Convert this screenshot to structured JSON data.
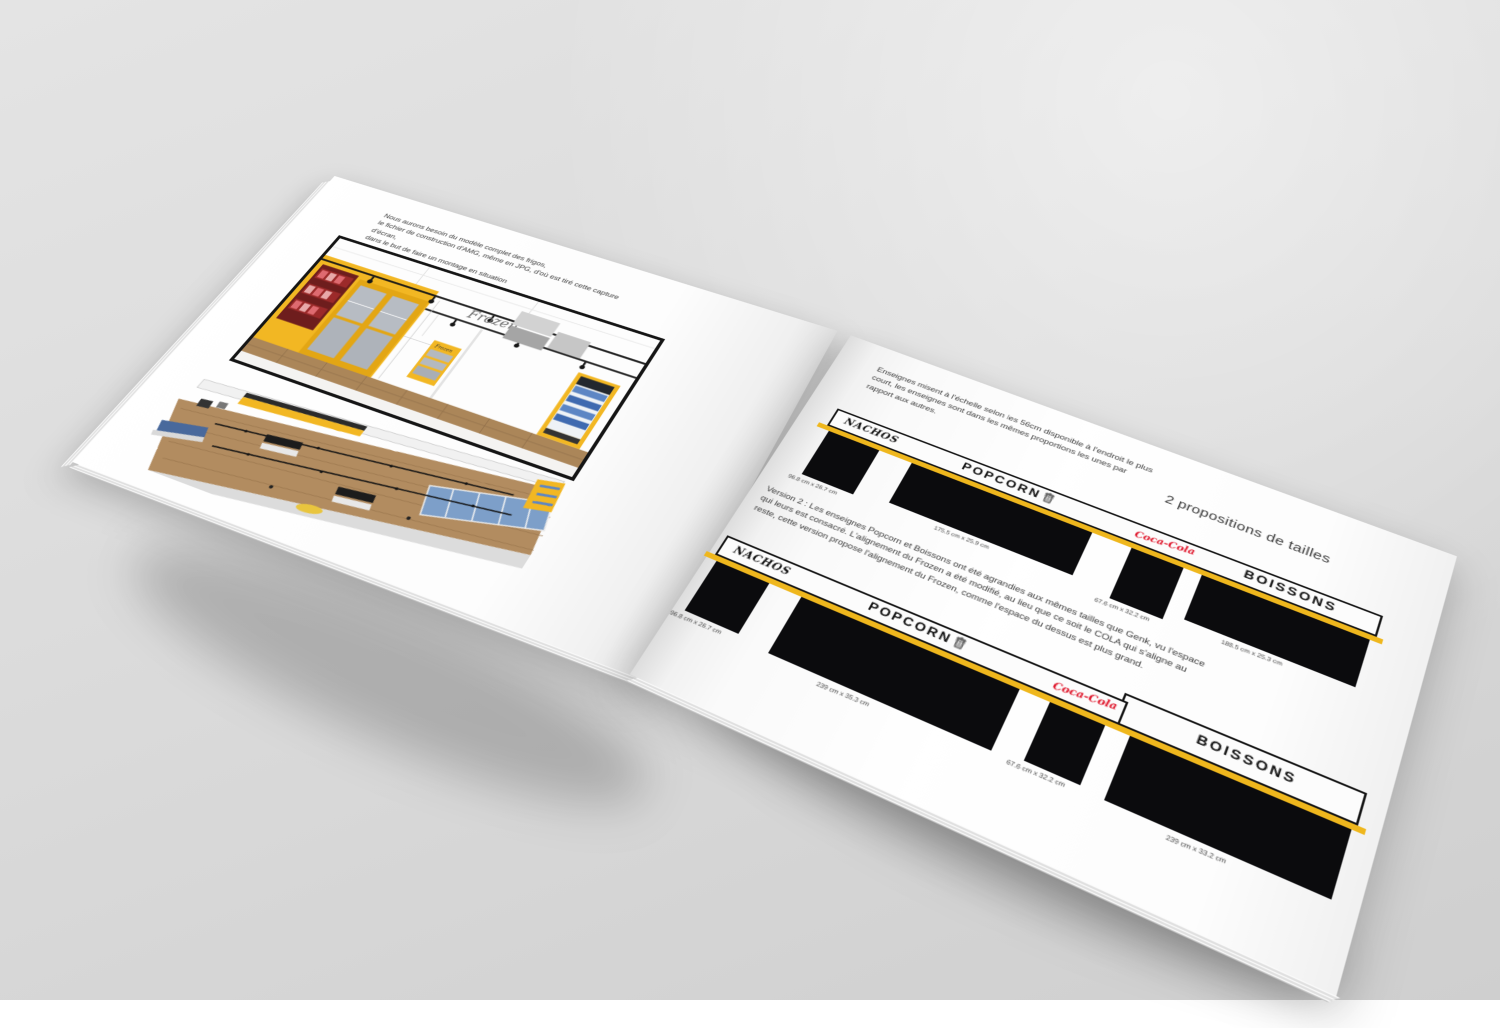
{
  "brand_colors": {
    "accent_yellow": "#efb71d",
    "sign_black": "#0b0b0d",
    "coca_cola_red": "#e0172c",
    "wood_floor": "#ae8a5e"
  },
  "left_page": {
    "intro_text": "Nous aurons besoin du modèle complet des frigos,\nle fichier de construction d'AMG, même en JPG, d'où est tiré cette capture d'écran,\ndans le but de faire un montage en situation",
    "frozen_wall_label": "Frozen",
    "frozen_cabinet_label": "Frozen"
  },
  "right_page": {
    "heading": "2 propositions de tailles",
    "intro_paragraph": "Enseignes misent à l'échelle selon les 56cm disponible à l'endroit le plus court, les enseignes sont dans les mêmes proportions les unes par rapport aux autres.",
    "version2_paragraph": "Version 2 : Les enseignes Popcorn et Boissons ont été agrandies aux mêmes tailles que Genk, vu l'espace qui leurs est consacré. L'alignement du Frozen a été modifié, au lieu que ce soit le COLA qui s'aligne au reste, cette version propose l'alignement du Frozen, comme l'espace du dessus est plus grand.",
    "version1": {
      "signs": [
        {
          "label": "NACHOS",
          "dimensions": "96.8 cm x 26.7 cm"
        },
        {
          "label": "POPCORN",
          "dimensions": "175.5 cm x 25.9 cm"
        },
        {
          "label": "Coca-Cola",
          "dimensions": "67.6 cm x 32.2 cm"
        },
        {
          "label": "BOISSONS",
          "dimensions": "188.5 cm x 25.3 cm"
        }
      ]
    },
    "version2": {
      "signs": [
        {
          "label": "NACHOS",
          "dimensions": "96.8 cm x 26.7 cm"
        },
        {
          "label": "POPCORN",
          "dimensions": "239 cm x 35.3 cm"
        },
        {
          "label": "Coca-Cola",
          "dimensions": "67.6 cm x 32.2 cm"
        },
        {
          "label": "BOISSONS",
          "dimensions": "239 cm x 33.2 cm"
        }
      ]
    }
  }
}
